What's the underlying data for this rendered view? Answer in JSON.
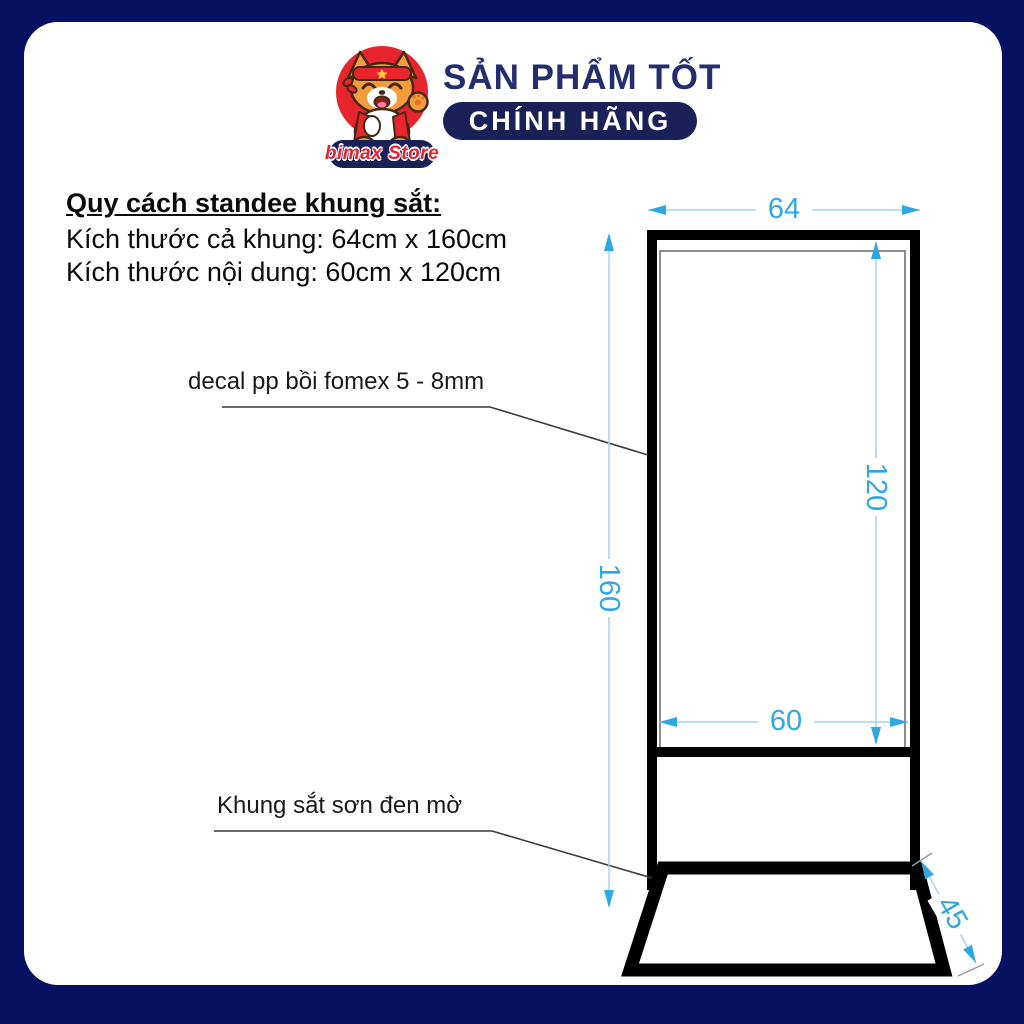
{
  "colors": {
    "border_navy": "#061161",
    "logo_navy": "#1a2058",
    "title_navy": "#232e6e",
    "brand_red": "#e8232e",
    "dimension_cyan": "#2fa8e2",
    "dimension_line_blue": "#a7d3ee",
    "frame_black": "#000000"
  },
  "header": {
    "store_name": "bimax Store",
    "slogan_top": "SẢN PHẨM TỐT",
    "slogan_badge": "CHÍNH HÃNG"
  },
  "specs": {
    "heading": "Quy cách standee khung sắt:",
    "frame_size": "Kích thước cả khung: 64cm x 160cm",
    "content_size": "Kích thước nội dung: 60cm x 120cm"
  },
  "callouts": {
    "decal": "decal pp bồi fomex 5 - 8mm",
    "frame": "Khung sắt sơn đen mờ"
  },
  "dimensions": {
    "frame_width": "64",
    "frame_height": "160",
    "content_height": "120",
    "content_width": "60",
    "base_depth": "45"
  }
}
